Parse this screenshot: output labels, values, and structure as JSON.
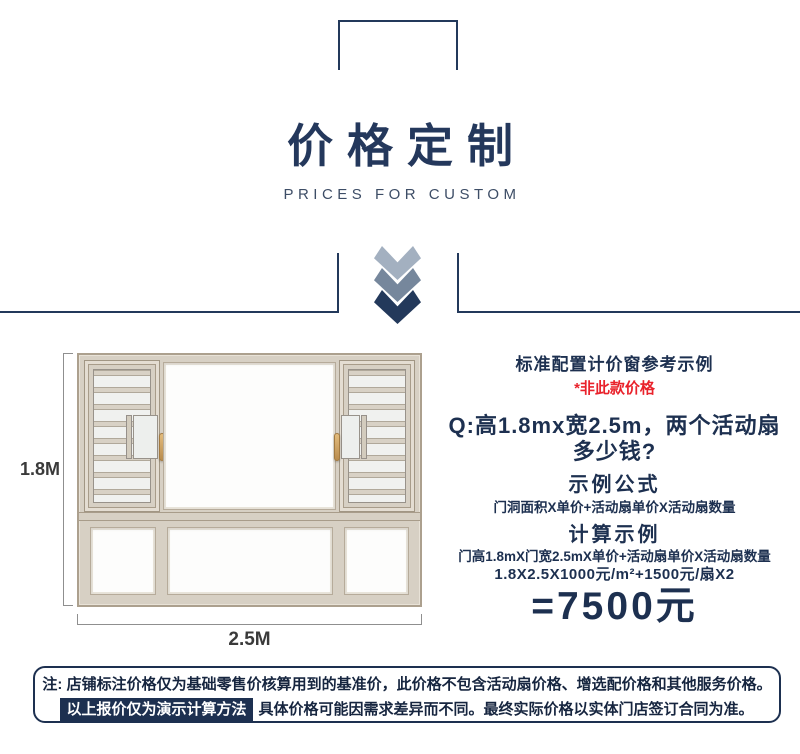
{
  "header": {
    "title": "价格定制",
    "subtitle": "PRICES FOR CUSTOM"
  },
  "pricing_panel": {
    "heading": "标准配置计价窗参考示例",
    "disclaimer": "*非此款价格",
    "question_line1": "Q:高1.8mx宽2.5m，两个活动扇",
    "question_line2": "多少钱?",
    "formula_title": "示例公式",
    "formula": "门洞面积X单价+活动扇单价X活动扇数量",
    "example_title": "计算示例",
    "example_line1": "门高1.8mX门宽2.5mX单价+活动扇单价X活动扇数量",
    "example_line2": "1.8X2.5X1000元/m²+1500元/扇X2",
    "result": "=7500元"
  },
  "window_diagram": {
    "height_label": "1.8M",
    "width_label": "2.5M"
  },
  "note": {
    "line1": "注: 店铺标注价格仅为基础零售价核算用到的基准价，此价格不包含活动扇价格、增选配价格和其他服务价格。",
    "highlight": "以上报价仅为演示计算方法",
    "line2": "具体价格可能因需求差异而不同。最终实际价格以实体门店签订合同为准。"
  },
  "colors": {
    "line_navy": "#23395b",
    "title_navy": "#24385c",
    "subtitle_navy": "#3d4d66",
    "text_navy": "#1d3050",
    "red": "#e9222b",
    "chevron_light": "#a3b0c0",
    "chevron_mid": "#76879c",
    "chevron_dark": "#23395b",
    "highlight_bg": "#1d3050",
    "frame_beige": "#d7d0c4",
    "handle_gold": "#c59a5f"
  }
}
